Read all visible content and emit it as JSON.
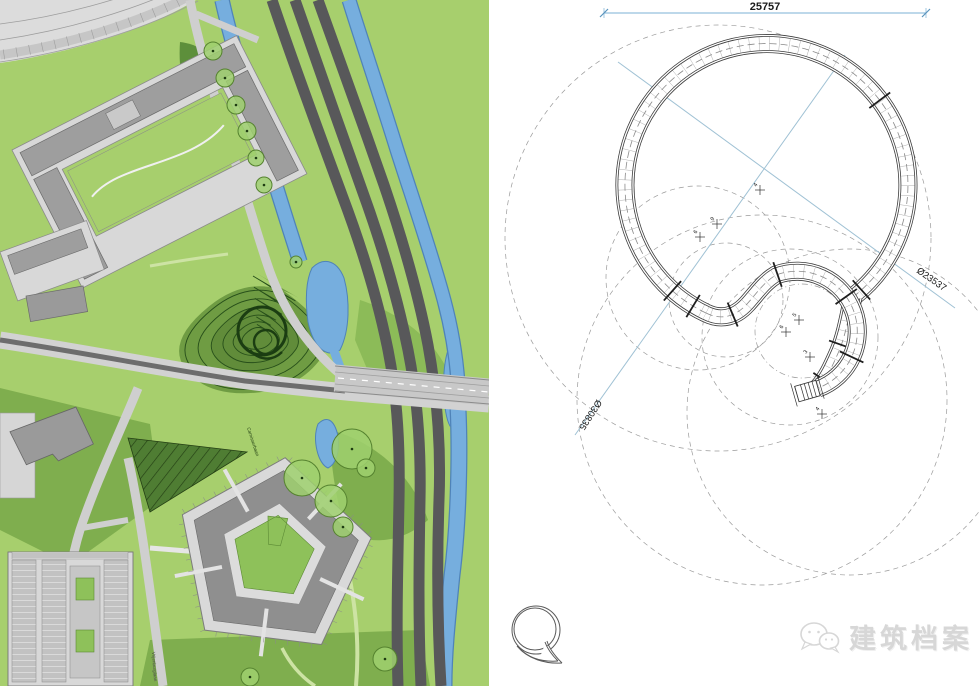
{
  "watermark": {
    "text": "建筑档案",
    "icon": "chat-bubbles-icon",
    "color": "#d7d7d7"
  },
  "drawing": {
    "title_hint": "spiral bridge plan",
    "total_width_dim": "25757",
    "diameters": [
      {
        "text": "Ø23537",
        "x": 916,
        "y": 272,
        "rot": 35
      },
      {
        "text": "Ø30835",
        "x": 597,
        "y": 399,
        "rot": 123
      }
    ],
    "center_marks": [
      {
        "x": 760,
        "y": 190,
        "label": "4"
      },
      {
        "x": 700,
        "y": 237,
        "label": "6"
      },
      {
        "x": 717,
        "y": 224,
        "label": "9"
      },
      {
        "x": 786,
        "y": 332,
        "label": "6"
      },
      {
        "x": 799,
        "y": 320,
        "label": "5"
      },
      {
        "x": 810,
        "y": 357,
        "label": "3"
      },
      {
        "x": 822,
        "y": 414,
        "label": "4"
      }
    ],
    "colors": {
      "dim_blue": "#7bb0d4",
      "line": "#3c3c3c",
      "dash": "#9a9a9a"
    }
  },
  "map": {
    "street_labels": [
      {
        "text": "Carnisserbaan",
        "x": 247,
        "y": 428,
        "rot": 72,
        "color": "#1d3a10"
      },
      {
        "text": "Vrijenburglaan",
        "x": 152,
        "y": 652,
        "rot": 86,
        "color": "#4a4a4a"
      }
    ],
    "colors": {
      "grass": "#a7cf6d",
      "grass_dark": "#7fae4e",
      "mound": "#6f9c43",
      "water": "#76aede",
      "water_edge": "#4f83b8",
      "road_dark": "#58585a",
      "road_light": "#cfcfcf",
      "building": "#d8d8d8",
      "building_dark": "#989898",
      "contour": "#274f1a"
    }
  }
}
